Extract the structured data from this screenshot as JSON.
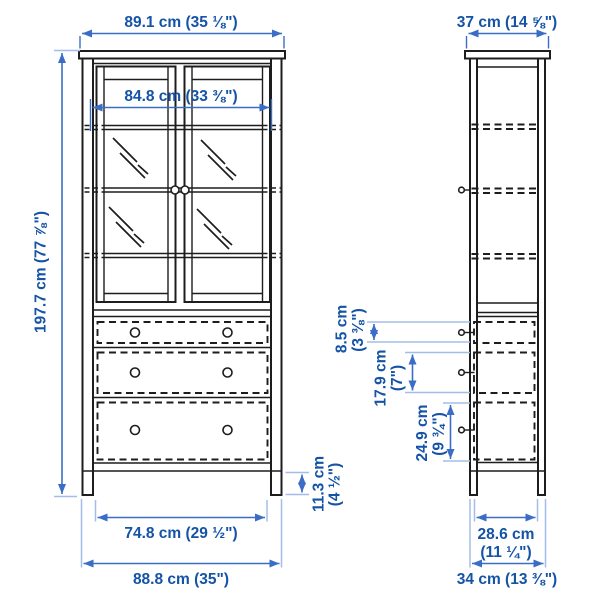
{
  "colors": {
    "outline": "#1d1d1d",
    "dimension_line": "#3a6ec6",
    "dimension_text": "#1453a6",
    "extension_line": "#a3bde8"
  },
  "front": {
    "top_width": "89.1 cm (35 ⅛\")",
    "inner_width": "84.8 cm (33 ⅜\")",
    "height": "197.7 cm (77 ⅞\")",
    "plinth_height_lines": [
      "11.3 cm",
      "(4 ½\")"
    ],
    "drawer_width": "74.8 cm (29 ½\")",
    "base_width": "88.8 cm (35\")"
  },
  "side": {
    "top_depth": "37 cm (14 ⅝\")",
    "top_drawer_height_lines": [
      "8.5 cm",
      "(3 ⅜\")"
    ],
    "middle_drawer_height_lines": [
      "17.9 cm",
      "(7\")"
    ],
    "bottom_drawer_height_lines": [
      "24.9 cm",
      "(9 ¾\")"
    ],
    "inner_depth_lines": [
      "28.6 cm",
      "(11 ¼\")"
    ],
    "base_depth": "34 cm (13 ⅜\")"
  }
}
